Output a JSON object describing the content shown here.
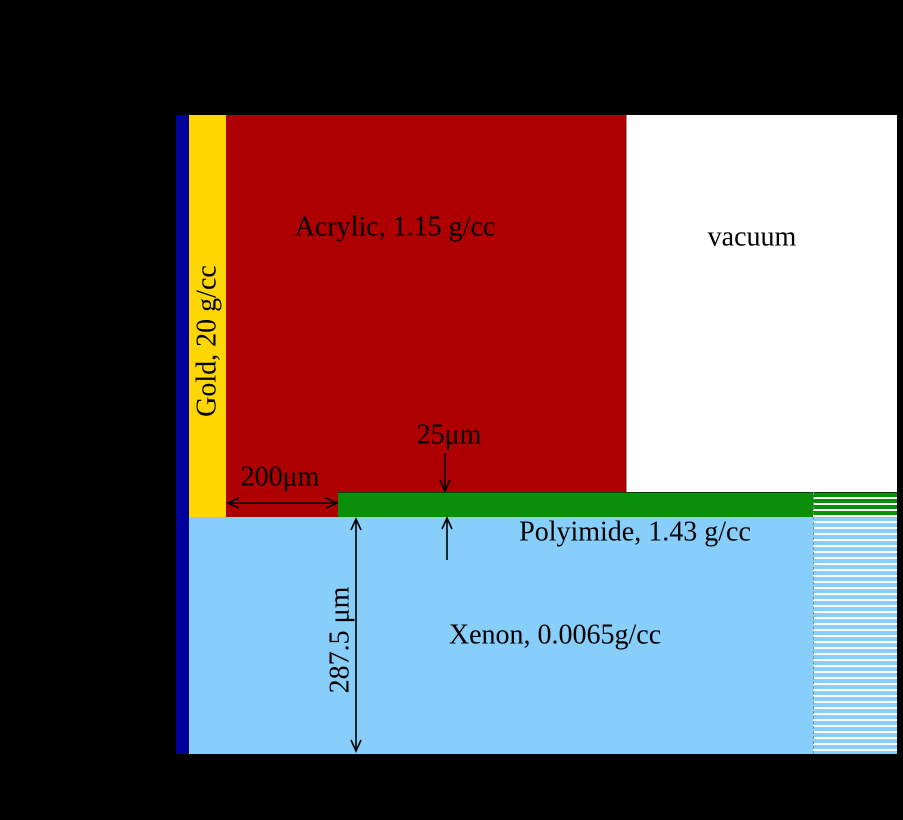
{
  "figure": {
    "background_color": "#000000",
    "regions": {
      "backing": {
        "color": "#00009B"
      },
      "gold": {
        "label": "Gold, 20 g/cc",
        "color": "#FFD700"
      },
      "acrylic": {
        "label": "Acrylic, 1.15 g/cc",
        "color": "#AE0000"
      },
      "vacuum": {
        "label": "vacuum",
        "color": "#FFFFFF"
      },
      "polyimide": {
        "label": "Polyimide, 1.43 g/cc",
        "color": "#0A8F0A"
      },
      "xenon": {
        "label": "Xenon, 0.0065g/cc",
        "color": "#87CEFA"
      }
    },
    "dimensions": {
      "gold_to_polyimide_gap": "200μm",
      "polyimide_thickness": "25μm",
      "xenon_depth": "287.5 μm"
    }
  }
}
